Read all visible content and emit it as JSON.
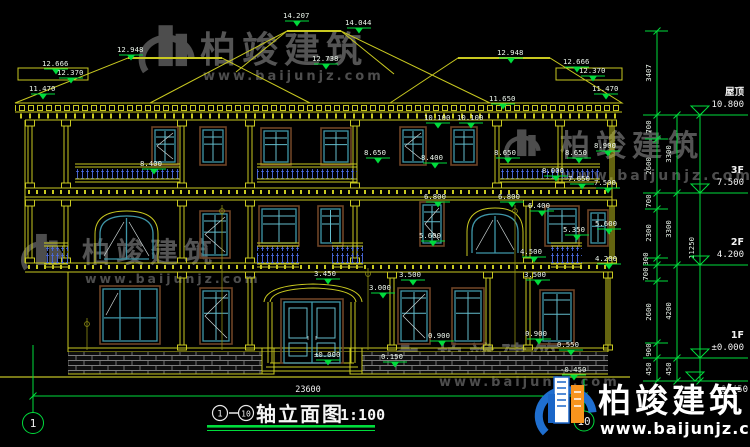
{
  "drawing": {
    "title": {
      "axis_start": "1",
      "axis_end": "10",
      "name": "轴立面图",
      "scale": "1:100"
    },
    "axis_bubbles": [
      "1",
      "10"
    ],
    "total_dim": "23600"
  },
  "floor_labels": [
    {
      "name": "屋顶",
      "level": "10.800"
    },
    {
      "name": "3F",
      "level": "7.500"
    },
    {
      "name": "2F",
      "level": "4.200"
    },
    {
      "name": "1F",
      "level": "±0.000"
    },
    {
      "name": "",
      "level": "-0.450"
    }
  ],
  "chain_dims": [
    "3407",
    "700",
    "2600",
    "700",
    "2300",
    "300",
    "700",
    "2600",
    "900",
    "450",
    "3300",
    "3300",
    "4200",
    "450",
    "11250"
  ],
  "elevation_marks": [
    "14.207",
    "14.044",
    "12.738",
    "12.948",
    "12.666",
    "12.370",
    "11.470",
    "12.948",
    "12.666",
    "12.370",
    "11.470",
    "11.650",
    "10.100",
    "10.100",
    "8.900",
    "8.650",
    "8.650",
    "8.650",
    "8.400",
    "8.400",
    "8.000",
    "7.650",
    "7.500",
    "6.800",
    "6.800",
    "6.400",
    "5.600",
    "5.350",
    "5.600",
    "4.500",
    "4.200",
    "3.500",
    "3.500",
    "3.450",
    "3.000",
    "0.900",
    "0.900",
    "0.550",
    "0.150",
    "±0.000",
    "-0.450"
  ],
  "watermark": {
    "brand": "柏竣建筑",
    "url": "www.baijunjz.com"
  },
  "colors": {
    "dim_green": "#00dc3c",
    "structure_yellow": "#c9c920",
    "window_teal": "#3f96a8",
    "baluster_blue": "#4a6ae0",
    "logo_blue": "#1a66c8",
    "logo_orange": "#f7941d"
  }
}
